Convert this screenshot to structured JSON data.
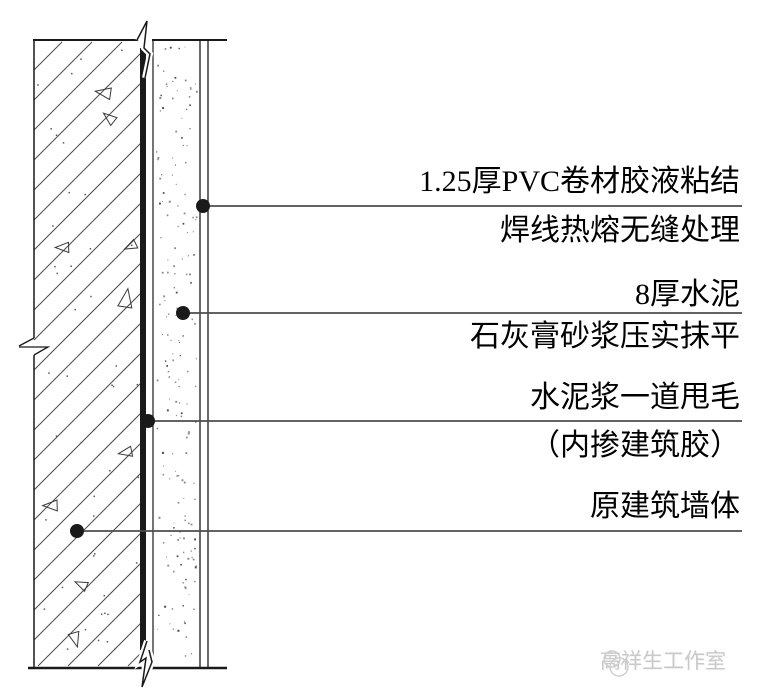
{
  "annotations": [
    {
      "label_line1": "1.25厚PVC卷材胶液粘结",
      "label_line2": "焊线热熔无缝处理"
    },
    {
      "label_line1": "8厚水泥",
      "label_line2": "石灰膏砂浆压实抹平"
    },
    {
      "label_line1": "水泥浆一道甩毛",
      "label_line2": "（内掺建筑胶）"
    },
    {
      "label_line1": "原建筑墙体"
    }
  ],
  "watermark": {
    "studio_name": "高祥生工作室"
  },
  "colors": {
    "drawing_line": "#1a1a1a",
    "leader_line": "#4d4d4d",
    "hatch_line": "#4a4a4a",
    "text": "#000000",
    "watermark": "#c9c9c9",
    "background": "#ffffff"
  }
}
